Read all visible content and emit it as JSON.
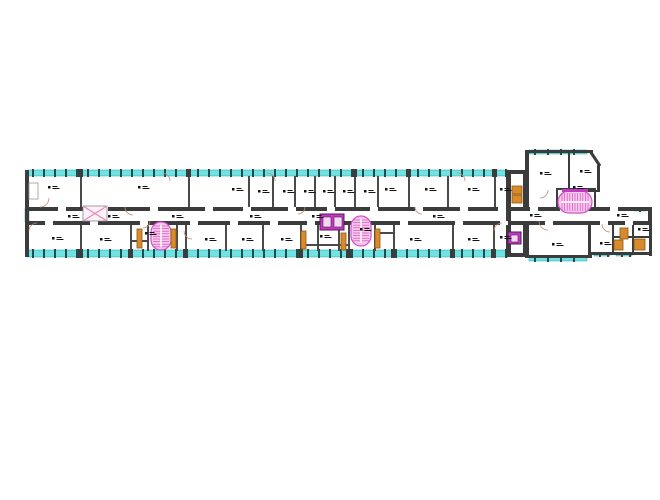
{
  "image": {
    "width": 660,
    "height": 500,
    "background": "#ffffff",
    "description_visible_text": ""
  },
  "colors": {
    "wall": "#3c3c3c",
    "partition": "#4a4a4a",
    "window_band": "#6fe3e3",
    "window_tick": "#1f4d4d",
    "stair_fill": "#f7c9e4",
    "stair_stroke": "#d24fd2",
    "elevator": "#c23ac2",
    "elevator_inner": "#f2d9f2",
    "door": "#d98a2b",
    "door_edge": "#8a5a14",
    "swing": "#c08a74",
    "tag": "#141414",
    "xbrace_fill": "#fdf1f7",
    "xbrace_line": "#e08ac0"
  },
  "floorplan": {
    "bands": [
      {
        "x": 27,
        "y": 170,
        "w": 481,
        "h": 6,
        "o": "h",
        "ticks": 11
      },
      {
        "x": 27,
        "y": 250,
        "w": 481,
        "h": 7,
        "o": "h",
        "ticks": 11
      },
      {
        "x": 25,
        "y": 208,
        "w": 4,
        "h": 14,
        "o": "v",
        "ticks": 0
      },
      {
        "x": 529,
        "y": 150,
        "w": 58,
        "h": 4,
        "o": "h",
        "ticks": 13
      },
      {
        "x": 529,
        "y": 257,
        "w": 58,
        "h": 4,
        "o": "h",
        "ticks": 13
      },
      {
        "x": 594,
        "y": 253,
        "w": 16,
        "h": 3,
        "o": "h",
        "ticks": 8
      },
      {
        "x": 616,
        "y": 253,
        "w": 16,
        "h": 3,
        "o": "h",
        "ticks": 8
      },
      {
        "x": 634,
        "y": 208,
        "w": 12,
        "h": 3,
        "o": "h",
        "ticks": 6
      }
    ],
    "band_breaks": [
      {
        "x": 78,
        "y": 169,
        "w": 5,
        "h": 8
      },
      {
        "x": 186,
        "y": 169,
        "w": 5,
        "h": 8
      },
      {
        "x": 352,
        "y": 169,
        "w": 5,
        "h": 8
      },
      {
        "x": 406,
        "y": 169,
        "w": 5,
        "h": 8
      },
      {
        "x": 492,
        "y": 169,
        "w": 5,
        "h": 8
      },
      {
        "x": 78,
        "y": 249,
        "w": 5,
        "h": 9
      },
      {
        "x": 128,
        "y": 249,
        "w": 5,
        "h": 9
      },
      {
        "x": 183,
        "y": 249,
        "w": 5,
        "h": 9
      },
      {
        "x": 298,
        "y": 249,
        "w": 5,
        "h": 9
      },
      {
        "x": 346,
        "y": 249,
        "w": 5,
        "h": 9
      },
      {
        "x": 391,
        "y": 249,
        "w": 5,
        "h": 9
      },
      {
        "x": 450,
        "y": 249,
        "w": 5,
        "h": 9
      },
      {
        "x": 491,
        "y": 249,
        "w": 5,
        "h": 9
      }
    ],
    "walls": [
      {
        "x": 25,
        "y": 170,
        "w": 4,
        "h": 87
      },
      {
        "x": 506,
        "y": 170,
        "w": 5,
        "h": 87
      },
      {
        "x": 27,
        "y": 207,
        "w": 479,
        "h": 4
      },
      {
        "x": 511,
        "y": 207,
        "w": 140,
        "h": 4
      },
      {
        "x": 27,
        "y": 221,
        "w": 479,
        "h": 4
      },
      {
        "x": 511,
        "y": 221,
        "w": 140,
        "h": 4
      },
      {
        "x": 523,
        "y": 170,
        "w": 4,
        "h": 37
      },
      {
        "x": 523,
        "y": 225,
        "w": 4,
        "h": 32
      },
      {
        "x": 506,
        "y": 170,
        "w": 21,
        "h": 4
      },
      {
        "x": 506,
        "y": 253,
        "w": 21,
        "h": 4
      },
      {
        "x": 525,
        "y": 150,
        "w": 4,
        "h": 57
      },
      {
        "x": 525,
        "y": 150,
        "w": 68,
        "h": 3
      },
      {
        "x": 597,
        "y": 165,
        "w": 3,
        "h": 27
      },
      {
        "x": 568,
        "y": 153,
        "w": 2,
        "h": 38
      },
      {
        "x": 568,
        "y": 190,
        "w": 32,
        "h": 2
      },
      {
        "x": 556,
        "y": 188,
        "w": 2,
        "h": 20
      },
      {
        "x": 594,
        "y": 188,
        "w": 2,
        "h": 20
      },
      {
        "x": 556,
        "y": 188,
        "w": 40,
        "h": 2
      },
      {
        "x": 648,
        "y": 207,
        "w": 4,
        "h": 18
      },
      {
        "x": 525,
        "y": 221,
        "w": 4,
        "h": 36
      },
      {
        "x": 588,
        "y": 221,
        "w": 3,
        "h": 36
      },
      {
        "x": 525,
        "y": 255,
        "w": 67,
        "h": 3
      },
      {
        "x": 649,
        "y": 221,
        "w": 3,
        "h": 35
      },
      {
        "x": 590,
        "y": 252,
        "w": 62,
        "h": 3
      },
      {
        "x": 612,
        "y": 225,
        "w": 2,
        "h": 27
      },
      {
        "x": 632,
        "y": 221,
        "w": 2,
        "h": 31
      },
      {
        "x": 612,
        "y": 236,
        "w": 40,
        "h": 2
      }
    ],
    "diag_walls": [
      {
        "x1": 590,
        "y1": 151,
        "x2": 600,
        "y2": 166,
        "w": 3
      }
    ],
    "partitions_top": {
      "y": 176,
      "h": 31,
      "xs": [
        80,
        188,
        248,
        272,
        294,
        314,
        334,
        354,
        377,
        408,
        447,
        494
      ]
    },
    "partitions_bottom": {
      "y": 225,
      "h": 26,
      "xs": [
        80,
        130,
        147,
        176,
        185,
        225,
        262,
        300,
        317,
        338,
        348,
        374,
        393,
        452,
        493
      ]
    },
    "sub_walls": [
      {
        "x": 130,
        "y": 240,
        "w": 17,
        "h": 2
      },
      {
        "x": 300,
        "y": 244,
        "w": 48,
        "h": 2
      },
      {
        "x": 374,
        "y": 232,
        "w": 19,
        "h": 2
      }
    ],
    "gaps_top_wall": {
      "y": 207,
      "h": 4,
      "w": 8,
      "xs": [
        58,
        100,
        150,
        205,
        243,
        288,
        327,
        370,
        415,
        460,
        498,
        530,
        560,
        610
      ]
    },
    "gaps_bottom_wall": {
      "y": 221,
      "h": 4,
      "w": 8,
      "xs": [
        45,
        90,
        140,
        190,
        230,
        270,
        307,
        355,
        400,
        455,
        500,
        545,
        600,
        625
      ]
    },
    "stairs_vertical": [
      {
        "x": 151,
        "y": 222,
        "w": 20,
        "h": 28
      },
      {
        "x": 351,
        "y": 216,
        "w": 20,
        "h": 30
      }
    ],
    "stair_horizontal": {
      "x": 558,
      "y": 191,
      "w": 34,
      "h": 22,
      "bar": {
        "x": 562,
        "y": 189,
        "w": 26,
        "h": 3
      }
    },
    "elevators": [
      {
        "x": 320,
        "y": 214,
        "w": 24,
        "h": 16,
        "inner": [
          {
            "x": 323,
            "y": 217,
            "w": 8,
            "h": 10
          },
          {
            "x": 334,
            "y": 217,
            "w": 8,
            "h": 10
          }
        ]
      },
      {
        "x": 508,
        "y": 232,
        "w": 13,
        "h": 12,
        "inner": [
          {
            "x": 511,
            "y": 235,
            "w": 7,
            "h": 7
          }
        ]
      }
    ],
    "xbrace": {
      "x": 83,
      "y": 206,
      "w": 24,
      "h": 15
    },
    "doors": [
      {
        "x": 137,
        "y": 229,
        "w": 5,
        "h": 19
      },
      {
        "x": 171,
        "y": 229,
        "w": 5,
        "h": 19
      },
      {
        "x": 301,
        "y": 231,
        "w": 5,
        "h": 18
      },
      {
        "x": 341,
        "y": 233,
        "w": 5,
        "h": 17
      },
      {
        "x": 375,
        "y": 229,
        "w": 5,
        "h": 19
      },
      {
        "x": 512,
        "y": 186,
        "w": 10,
        "h": 8
      },
      {
        "x": 512,
        "y": 195,
        "w": 10,
        "h": 8
      },
      {
        "x": 620,
        "y": 228,
        "w": 8,
        "h": 11
      },
      {
        "x": 614,
        "y": 240,
        "w": 9,
        "h": 10
      },
      {
        "x": 634,
        "y": 239,
        "w": 11,
        "h": 11
      }
    ],
    "door_leaf": {
      "x": 29,
      "y": 183,
      "w": 9,
      "h": 16
    },
    "swings": [
      {
        "cx": 40,
        "cy": 198,
        "r": 9,
        "q": 0
      },
      {
        "cx": 162,
        "cy": 181,
        "r": 8,
        "q": 3
      },
      {
        "cx": 267,
        "cy": 181,
        "r": 8,
        "q": 3
      },
      {
        "cx": 457,
        "cy": 181,
        "r": 8,
        "q": 3
      },
      {
        "cx": 92,
        "cy": 207,
        "r": 8,
        "q": 0
      },
      {
        "cx": 133,
        "cy": 207,
        "r": 8,
        "q": 1
      },
      {
        "cx": 298,
        "cy": 207,
        "r": 7,
        "q": 0
      },
      {
        "cx": 422,
        "cy": 207,
        "r": 7,
        "q": 1
      },
      {
        "cx": 37,
        "cy": 231,
        "r": 8,
        "q": 2
      },
      {
        "cx": 143,
        "cy": 221,
        "r": 7,
        "q": 0
      },
      {
        "cx": 192,
        "cy": 231,
        "r": 8,
        "q": 1
      },
      {
        "cx": 362,
        "cy": 221,
        "r": 7,
        "q": 0
      },
      {
        "cx": 502,
        "cy": 231,
        "r": 8,
        "q": 2
      },
      {
        "cx": 548,
        "cy": 221,
        "r": 9,
        "q": 1
      },
      {
        "cx": 610,
        "cy": 224,
        "r": 8,
        "q": 1
      },
      {
        "cx": 540,
        "cy": 190,
        "r": 8,
        "q": 0
      }
    ],
    "tags": [
      [
        48,
        186
      ],
      [
        138,
        186
      ],
      [
        232,
        188
      ],
      [
        258,
        190
      ],
      [
        283,
        190
      ],
      [
        304,
        190
      ],
      [
        323,
        190
      ],
      [
        343,
        190
      ],
      [
        364,
        190
      ],
      [
        385,
        188
      ],
      [
        425,
        188
      ],
      [
        468,
        188
      ],
      [
        500,
        188
      ],
      [
        68,
        215
      ],
      [
        108,
        215
      ],
      [
        172,
        215
      ],
      [
        250,
        215
      ],
      [
        312,
        215
      ],
      [
        433,
        215
      ],
      [
        530,
        214
      ],
      [
        617,
        214
      ],
      [
        52,
        237
      ],
      [
        100,
        238
      ],
      [
        145,
        232
      ],
      [
        205,
        238
      ],
      [
        242,
        238
      ],
      [
        281,
        238
      ],
      [
        320,
        235
      ],
      [
        360,
        228
      ],
      [
        410,
        238
      ],
      [
        468,
        238
      ],
      [
        500,
        236
      ],
      [
        552,
        243
      ],
      [
        600,
        242
      ],
      [
        638,
        228
      ],
      [
        540,
        172
      ],
      [
        580,
        170
      ],
      [
        573,
        186
      ]
    ]
  }
}
